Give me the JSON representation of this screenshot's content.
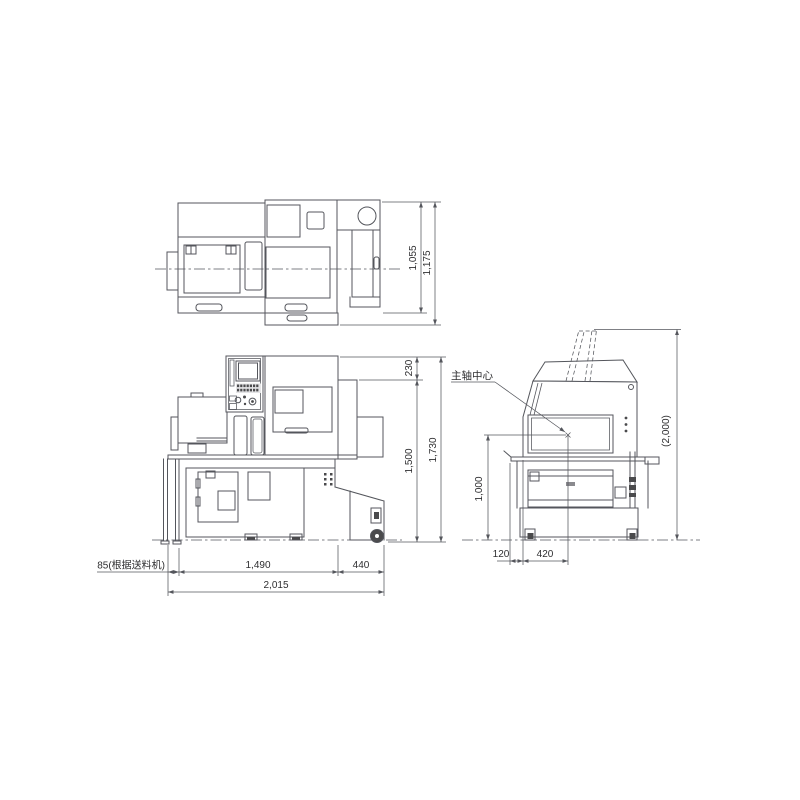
{
  "page": {
    "background": "#ffffff"
  },
  "drawing": {
    "type": "machine-dimension-diagram",
    "views": {
      "top_view": {
        "dims": {
          "body_depth": "1,055",
          "total_depth": "1,175"
        }
      },
      "front_view": {
        "dims": {
          "top_to_panel": "230",
          "body_height": "1,500",
          "total_height": "1,730",
          "feeder_offset": "85(根据送料机)",
          "body_width": "1,490",
          "right_section_width": "440",
          "total_width": "2,015"
        }
      },
      "side_view": {
        "labels": {
          "spindle_center": "主轴中心"
        },
        "dims": {
          "open_cover_height": "(2,000)",
          "spindle_center_height": "1,000",
          "front_offset": "120",
          "spindle_center_depth": "420"
        }
      }
    },
    "colors": {
      "line": "#54565c",
      "text": "#2e2e30",
      "background": "#ffffff"
    }
  }
}
